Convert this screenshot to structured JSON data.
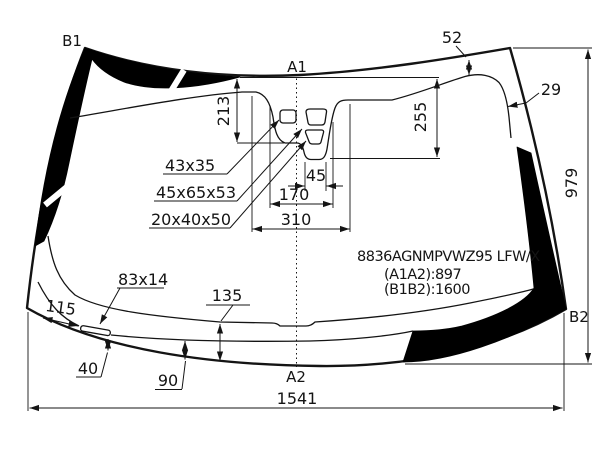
{
  "title": "windshield-technical-drawing",
  "corner_labels": {
    "top_left": "B1",
    "top_center": "A1",
    "bottom_center": "A2",
    "bottom_right": "B2"
  },
  "part_info": {
    "part_number": "8836AGNMPVWZ95 LFW/X",
    "a1a2_length": "(A1A2):897",
    "b1b2_length": "(B1B2):1600"
  },
  "dimensions": {
    "overall_width": "1541",
    "overall_height": "979",
    "top_band_width": "52",
    "side_band_width": "29",
    "sensor_area_depth_1": "213",
    "sensor_area_depth_2": "255",
    "sensor_pocket_width": "45",
    "sensor_bump_width": "170",
    "sensor_bump_base_width": "310",
    "bottom_band_depth_1": "135",
    "bottom_band_depth_2": "90",
    "vin_offset": "115",
    "vin_to_edge": "40"
  },
  "feature_sizes": {
    "mirror_button": "43x35",
    "sensor_housing": "45x65x53",
    "sensor_window": "20x40x50",
    "vin_window": "83x14"
  },
  "colors": {
    "line": "#141414",
    "band_fill": "#000000",
    "background": "#ffffff"
  }
}
